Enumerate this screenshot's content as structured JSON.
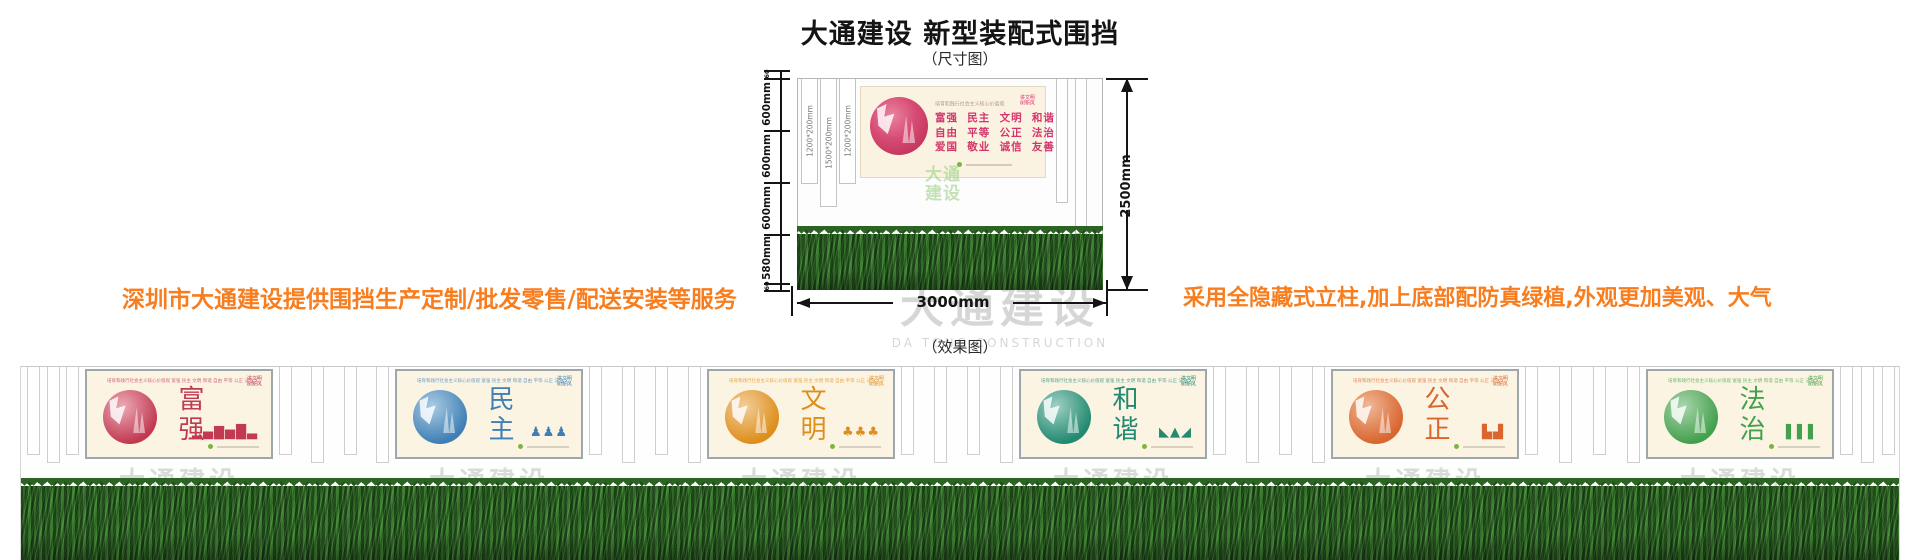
{
  "header": {
    "title": "大通建设 新型装配式围挡",
    "dim_caption": "（尺寸图）",
    "effect_caption": "（效果图）"
  },
  "taglines": {
    "left": "深圳市大通建设提供围挡生产定制/批发零售/配送安装等服务",
    "right": "采用全隐藏式立柱,加上底部配防真绿植,外观更加美观、大气",
    "color": "#F87D1E"
  },
  "dimension_diagram": {
    "total_height_label": "2500mm",
    "total_width_label": "3000mm",
    "left_segment_labels": [
      "60",
      "600mm",
      "600mm",
      "600mm",
      "580mm",
      "60"
    ],
    "post_labels": [
      "1200*200mm",
      "1500*200mm",
      "1200*200mm"
    ],
    "banner": {
      "tiny_header": "培育和践行社会主义核心价值观",
      "values_line1": "富强  民主  文明  和谐",
      "values_line2": "自由  平等  公正  法治",
      "values_line3": "爱国  敬业  诚信  友善",
      "corner_text": "讲文明\n树新风",
      "accent_color": "#D4356B"
    },
    "green_watermark": "大通\n建设"
  },
  "watermark": {
    "cn": "大通建设",
    "en": "DA TONG CONSTRUCTION"
  },
  "effect_fence": {
    "core_values_header": "培育和践行社会主义核心价值观  富强 民主 文明 和谐 自由 平等 公正 法治 爱国 敬业 诚信 友善",
    "corner_text": "讲文明\n树新风",
    "panels": [
      {
        "title": "富强",
        "theme_color": "#C13A52",
        "theme_light": "#ECA9B6",
        "motif_name": "city-skyline-icon",
        "motif_glyphs": "▂▄▇▅█▃"
      },
      {
        "title": "民主",
        "theme_color": "#3F7FB5",
        "theme_light": "#A9CBE3",
        "motif_name": "people-figures-icon",
        "motif_glyphs": "♟♟♟"
      },
      {
        "title": "文明",
        "theme_color": "#DE8E1B",
        "theme_light": "#F2CE9A",
        "motif_name": "trees-icon",
        "motif_glyphs": "♣♣♣"
      },
      {
        "title": "和谐",
        "theme_color": "#238970",
        "theme_light": "#9ED0C4",
        "motif_name": "mountains-icon",
        "motif_glyphs": "◣▲◢"
      },
      {
        "title": "公正",
        "theme_color": "#D9652F",
        "theme_light": "#F0B896",
        "motif_name": "open-book-icon",
        "motif_glyphs": "▙▟"
      },
      {
        "title": "法治",
        "theme_color": "#43A04D",
        "theme_light": "#A8D5AC",
        "motif_name": "bamboo-icon",
        "motif_glyphs": "▌▌▌"
      }
    ]
  }
}
